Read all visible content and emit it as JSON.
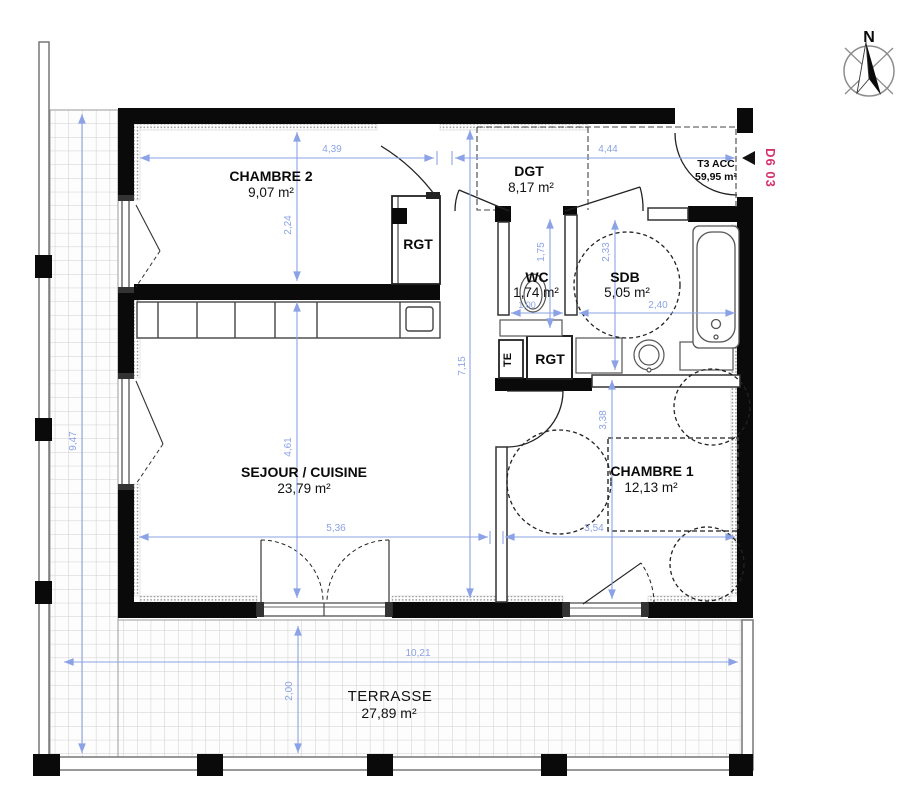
{
  "compass": {
    "north_label": "N"
  },
  "unit": {
    "code": "D6 03",
    "type_label": "T3 ACC",
    "total_area": "59,95 m²"
  },
  "rooms": {
    "chambre2": {
      "name": "CHAMBRE 2",
      "area": "9,07 m²"
    },
    "dgt": {
      "name": "DGT",
      "area": "8,17 m²"
    },
    "wc": {
      "name": "WC",
      "area": "1,74 m²"
    },
    "sdb": {
      "name": "SDB",
      "area": "5,05 m²"
    },
    "rgt_chambre2": {
      "name": "RGT"
    },
    "rgt_couloir": {
      "name": "RGT"
    },
    "te": {
      "name": "TE"
    },
    "sejour": {
      "name": "SEJOUR / CUISINE",
      "area": "23,79 m²"
    },
    "chambre1": {
      "name": "CHAMBRE 1",
      "area": "12,13 m²"
    },
    "terrasse": {
      "name": "TERRASSE",
      "area": "27,89 m²"
    }
  },
  "dimensions": {
    "chambre2_largeur": "4,39",
    "entree_largeur": "4,44",
    "chambre2_profondeur": "2,24",
    "interieur_hauteur": "7,15",
    "sejour_profondeur": "4,61",
    "sejour_largeur": "5,36",
    "chambre1_largeur": "3,54",
    "chambre1_profondeur": "3,38",
    "wc_profondeur": "1,75",
    "wc_largeur": "1,00",
    "sdb_profondeur": "2,33",
    "sdb_largeur": "2,40",
    "terrasse_largeur": "10,21",
    "terrasse_profondeur": "2,00",
    "terrasse_cote": "9,47"
  },
  "colors": {
    "dimension_blue": "#8ba3e6",
    "unit_code_pink": "#d4326e",
    "wall_black": "#0a0a0a",
    "grid_gray": "#cfcfcf"
  }
}
